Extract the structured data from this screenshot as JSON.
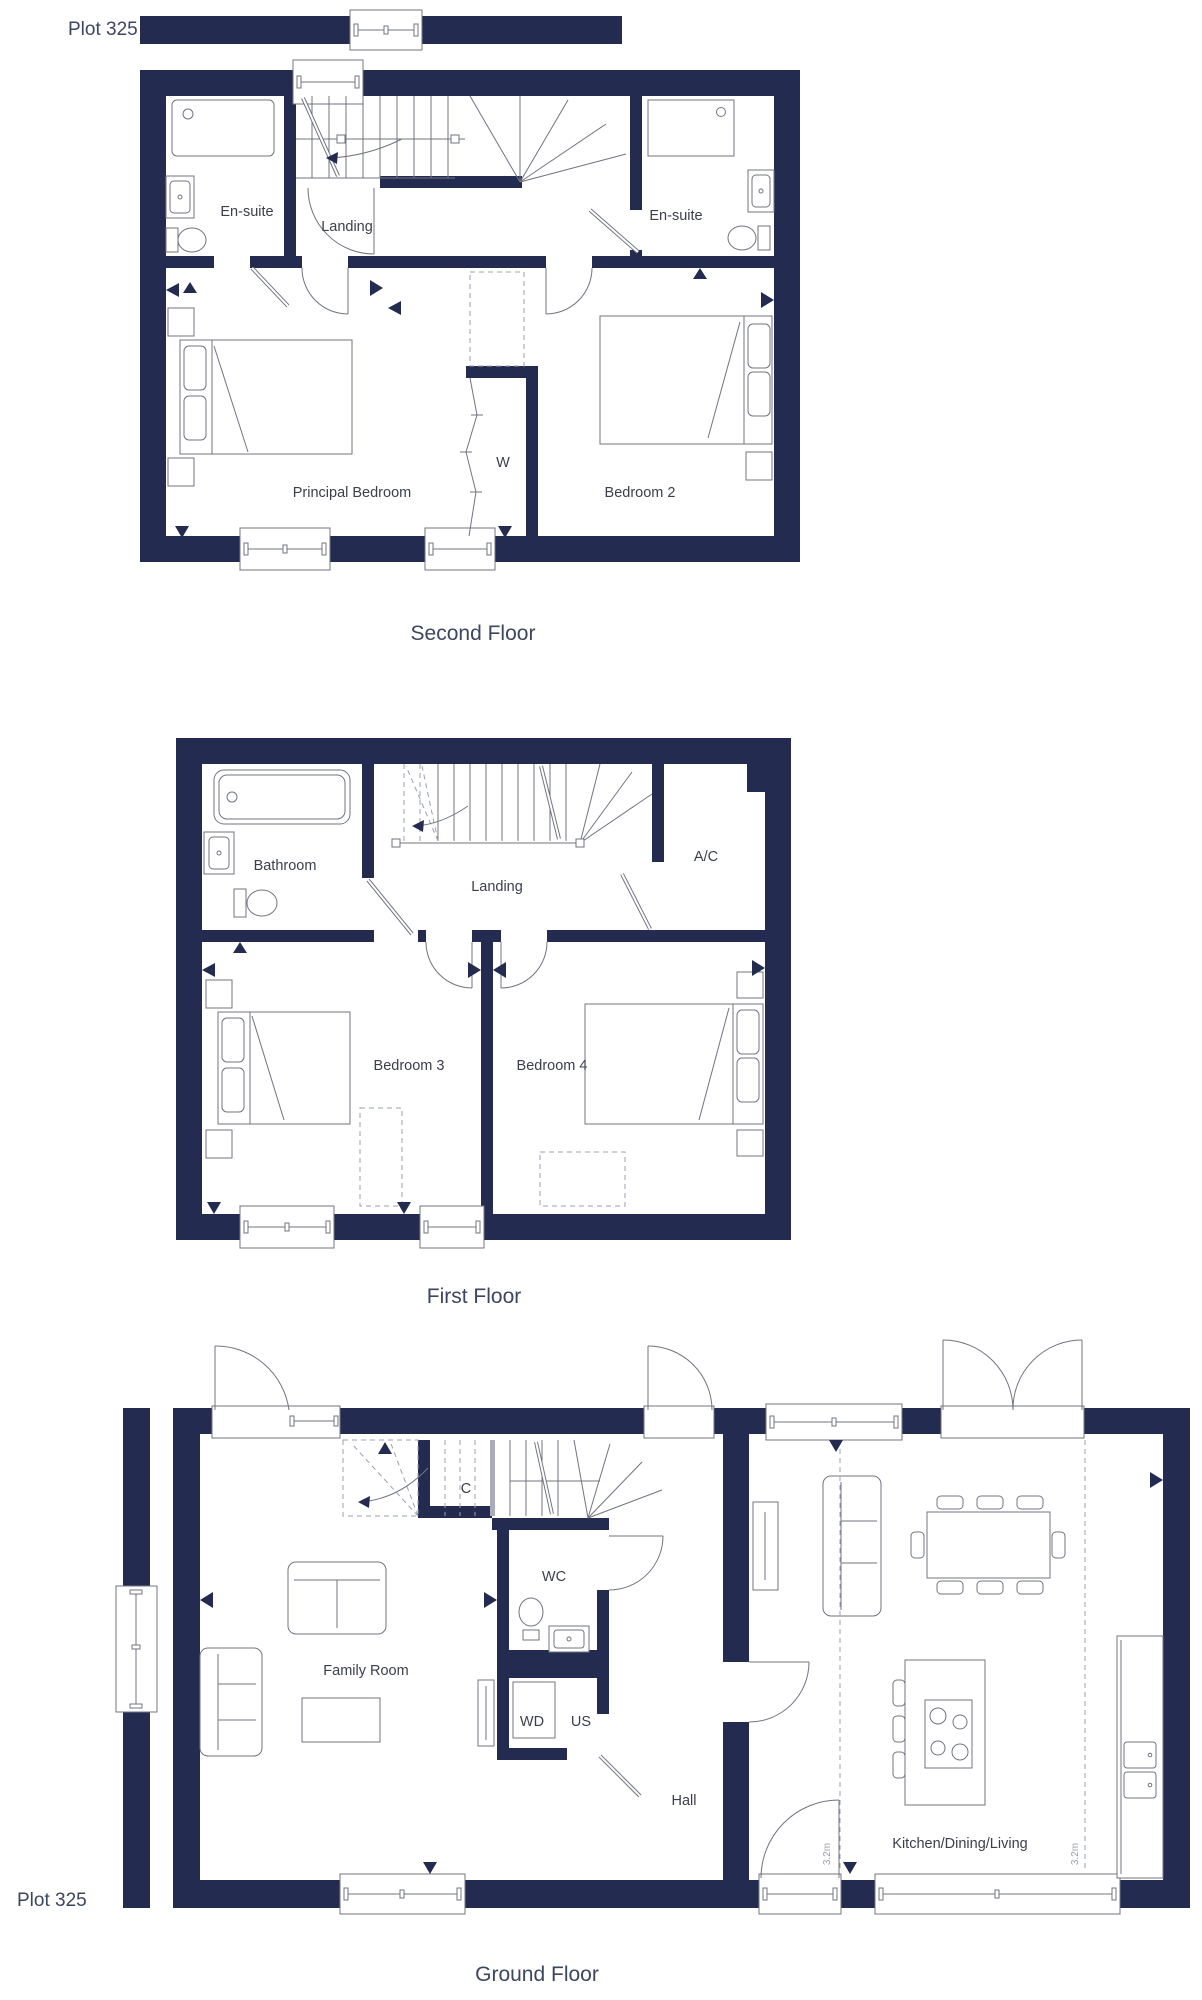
{
  "plot": {
    "top": "Plot 325",
    "bottom": "Plot 325"
  },
  "floors": [
    {
      "title": "Second Floor",
      "rooms": {
        "ensuite_left": "En-suite",
        "landing": "Landing",
        "ensuite_right": "En-suite",
        "wardrobe": "W",
        "principal": "Principal Bedroom",
        "bedroom2": "Bedroom 2"
      }
    },
    {
      "title": "First Floor",
      "rooms": {
        "bathroom": "Bathroom",
        "landing": "Landing",
        "ac": "A/C",
        "bedroom3": "Bedroom 3",
        "bedroom4": "Bedroom 4"
      }
    },
    {
      "title": "Ground Floor",
      "rooms": {
        "cupboard": "C",
        "wc": "WC",
        "family": "Family Room",
        "wd": "WD",
        "us": "US",
        "hall": "Hall",
        "kitchen": "Kitchen/Dining/Living"
      },
      "dimensions": {
        "left": "3.2m",
        "right": "3.2m"
      }
    }
  ],
  "colors": {
    "wall": "#232b50",
    "line": "#70747f",
    "dashed": "#9aa0b0",
    "text": "#3b3f4b",
    "title": "#3c4660",
    "dim": "#9aa0ab"
  }
}
